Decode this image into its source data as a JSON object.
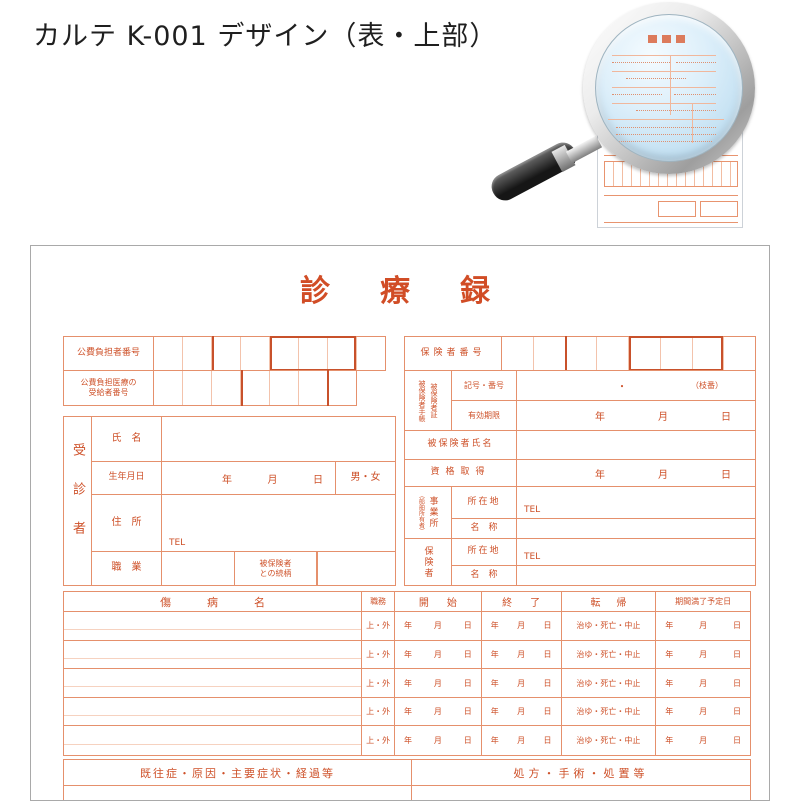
{
  "heading": "カルテ K-001 デザイン（表・上部）",
  "magnifier": {
    "icon": "magnifying-glass-icon"
  },
  "colors": {
    "form_line": "#E5906C",
    "form_line_thick": "#C8512B",
    "form_text": "#CE5129",
    "title_text": "#D14D26",
    "lens_tint": "#CFE7F6"
  },
  "karte": {
    "title": "診　療　録",
    "date": {
      "y": "年",
      "m": "月",
      "d": "日"
    },
    "top_left": {
      "payer_number_label": "公費負担者番号",
      "payer_cells": 8,
      "recipient_label_line1": "公費負担医療の",
      "recipient_label_line2": "受給者番号",
      "recipient_cells": 7
    },
    "top_right": {
      "insurer_number_label": "保険者番号",
      "insurer_cells": 8,
      "card_label_col1": "被保険者手帳",
      "card_label_col2": "被保険者証",
      "symbol_label": "記号・番号",
      "symbol_separator": "・",
      "branch_note": "（枝番）",
      "validity_label": "有効期限"
    },
    "patient": {
      "group_label": "受診者",
      "name_label": "氏　名",
      "birth_label": "生年月日",
      "gender_options": "男・女",
      "address_label": "住　所",
      "tel_label": "TEL",
      "job_label": "職　業",
      "relation_line1": "被保険者",
      "relation_line2": "との続柄"
    },
    "insured": {
      "name_label": "被保険者氏名",
      "qualification_label": "資格取得",
      "workplace_label": "事業所",
      "workplace_note": "（船舶所有者）",
      "location_label": "所在地",
      "tel_label": "TEL",
      "org_label": "名　称",
      "insurer_label": "保険者"
    },
    "disease_table": {
      "row_count": 5,
      "headers": {
        "name": "傷病名",
        "duty": "職務",
        "start": "開始",
        "end": "終了",
        "outcome": "転帰",
        "expiry": "期間満了予定日"
      },
      "row": {
        "duty": "上・外",
        "outcome": "治ゆ・死亡・中止"
      }
    },
    "bottom": {
      "left_header": "既往症・原因・主要症状・経過等",
      "right_header": "処方・手術・処置等"
    }
  }
}
